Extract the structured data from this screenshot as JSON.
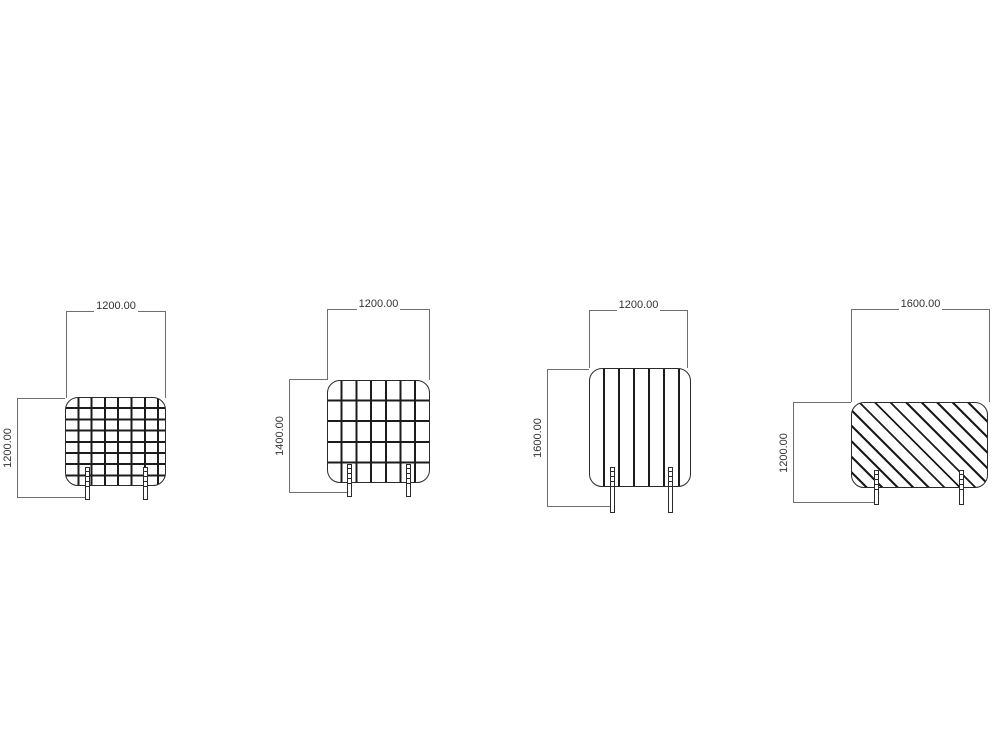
{
  "drawing": {
    "background": "#ffffff",
    "panel_line_color": "#2a2a2a",
    "hatch_line_color": "#1c1c1c",
    "dimension_line_color": "#6e6e6e",
    "dimension_text_color": "#333333",
    "panels": [
      {
        "name": "screen-panel-1",
        "pattern": "square-mesh",
        "width_label": "1200.00",
        "height_label": "1200.00",
        "feet_count": 2
      },
      {
        "name": "screen-panel-2",
        "pattern": "wide-mesh",
        "width_label": "1200.00",
        "height_label": "1400.00",
        "feet_count": 2
      },
      {
        "name": "screen-panel-3",
        "pattern": "vertical-slats",
        "width_label": "1200.00",
        "height_label": "1600.00",
        "feet_count": 2
      },
      {
        "name": "screen-panel-4",
        "pattern": "diagonal-hatch",
        "width_label": "1600.00",
        "height_label": "1200.00",
        "feet_count": 2
      }
    ]
  }
}
